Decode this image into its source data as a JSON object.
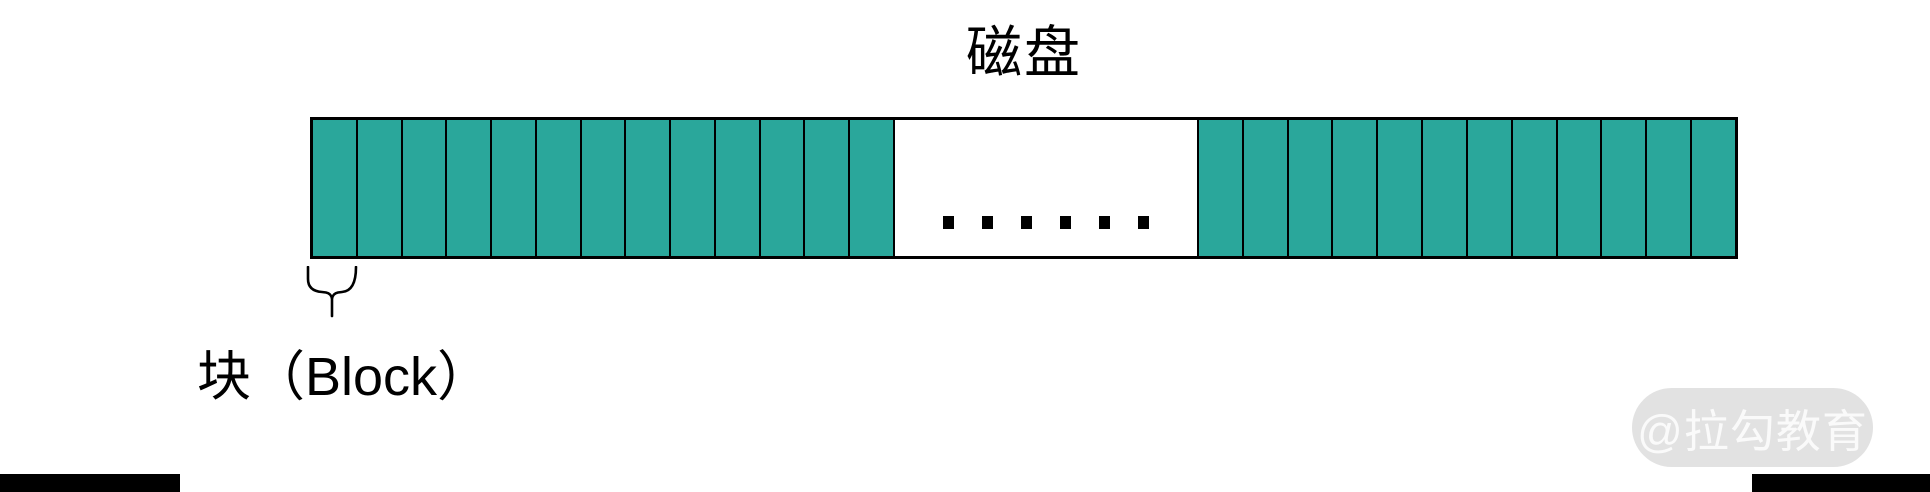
{
  "title": "磁盘",
  "disk": {
    "left_block_count": 13,
    "right_block_count": 12,
    "gap_dot_count": 6,
    "block_fill": "#2AA79B",
    "border_color": "#000000"
  },
  "block_label": "块（Block）",
  "watermark": "@拉勾教育"
}
